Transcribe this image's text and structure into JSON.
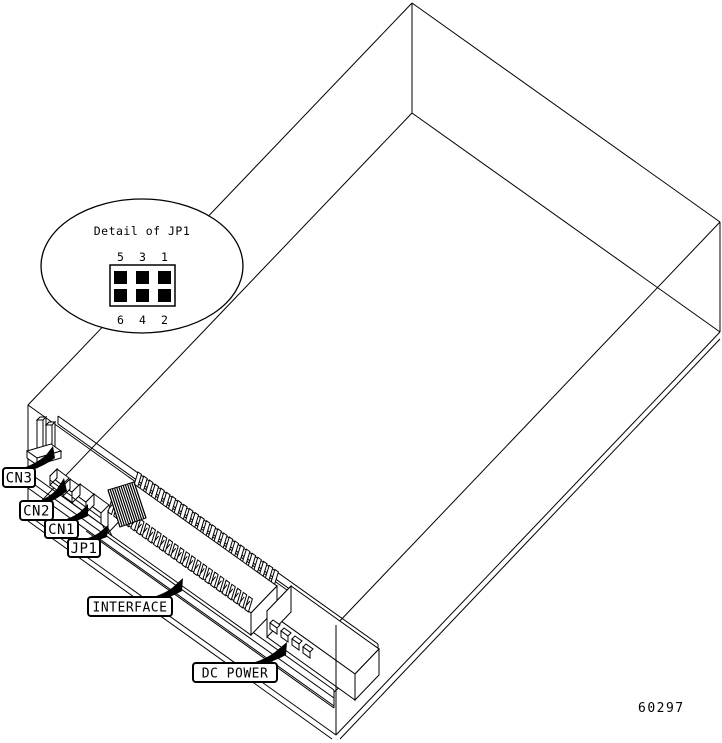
{
  "figure": {
    "part_number": "60297",
    "detail": {
      "title": "Detail of JP1",
      "pin_numbers_top": [
        "5",
        "3",
        "1"
      ],
      "pin_numbers_bottom": [
        "6",
        "4",
        "2"
      ]
    },
    "callouts": [
      {
        "id": "cn3",
        "label": "CN3"
      },
      {
        "id": "cn2",
        "label": "CN2"
      },
      {
        "id": "cn1",
        "label": "CN1"
      },
      {
        "id": "jp1",
        "label": "JP1"
      },
      {
        "id": "interface",
        "label": "INTERFACE"
      },
      {
        "id": "dc_power",
        "label": "DC POWER"
      }
    ],
    "colors": {
      "line": "#000000",
      "background": "#ffffff"
    }
  }
}
